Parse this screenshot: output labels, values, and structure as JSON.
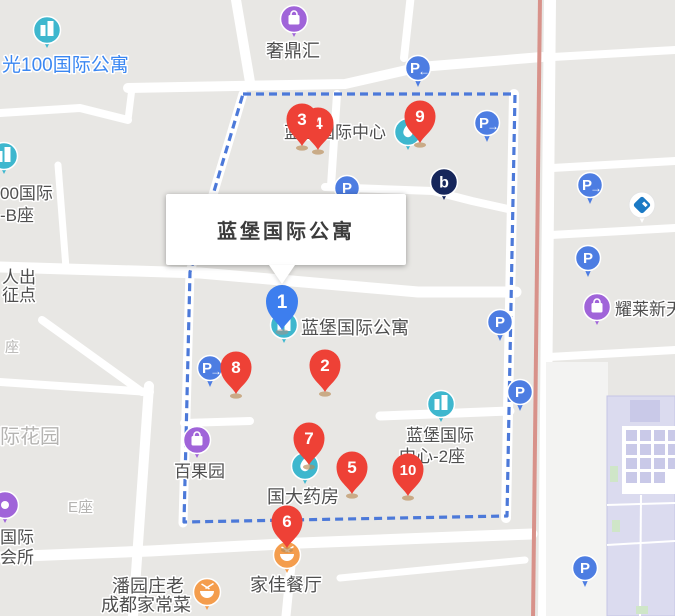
{
  "infobox": {
    "title": "蓝堡国际公寓"
  },
  "markers": {
    "selected": {
      "number": "1"
    },
    "numbered": [
      "2",
      "3",
      "4",
      "5",
      "6",
      "7",
      "8",
      "9",
      "10"
    ]
  },
  "parking": {
    "letter": "P",
    "arrow_left": "←",
    "arrow_right": "→"
  },
  "pois": [
    {
      "id": "guang100",
      "icon": "building",
      "label": "光100国际公寓"
    },
    {
      "id": "bzuo-complex",
      "icon": "building",
      "label_lines": [
        "00国际",
        "-B座"
      ]
    },
    {
      "id": "shedinghui",
      "icon": "shopping-bag",
      "label": "奢鼎汇"
    },
    {
      "id": "lanbao-center",
      "icon": "drop",
      "label": "蓝堡国际中心"
    },
    {
      "id": "brand-b",
      "icon": "letter-b",
      "text": "b"
    },
    {
      "id": "ccb-bank",
      "icon": "bank"
    },
    {
      "id": "lanbao-apartment",
      "icon": "building",
      "label": "蓝堡国际公寓"
    },
    {
      "id": "baiguoyuan",
      "icon": "shopping-bag",
      "label": "百果园"
    },
    {
      "id": "guoda-pharmacy",
      "icon": "drop",
      "label": "国大药房"
    },
    {
      "id": "lanbao-center-2",
      "icon": "building",
      "label_lines": [
        "蓝堡国际",
        "中心-2座"
      ]
    },
    {
      "id": "yaolai",
      "icon": "shopping-bag",
      "label": "耀莱新天"
    },
    {
      "id": "club",
      "icon": "dot",
      "label_lines": [
        "国际",
        "会所"
      ]
    },
    {
      "id": "jiajia-restaurant",
      "icon": "food-bowl",
      "label": "家佳餐厅"
    },
    {
      "id": "panyuanzhuang",
      "icon": "food-bowl",
      "label_lines": [
        "潘园庄老",
        "成都家常菜"
      ]
    }
  ],
  "area_labels": [
    {
      "id": "renchu",
      "lines": [
        "人出",
        "征点"
      ]
    },
    {
      "id": "zuo",
      "text": "座"
    },
    {
      "id": "jihuayuan",
      "text": "际花园"
    },
    {
      "id": "ezuo",
      "text": "E座"
    }
  ],
  "colors": {
    "red_marker": "#ee4136",
    "blue_marker": "#3d7eee",
    "parking_blue": "#4d7de2",
    "teal_poi": "#3eb7ce",
    "purple_poi": "#a064d9",
    "orange_poi": "#f49d4d",
    "navy_brand": "#16265b",
    "bank_blue": "#1b79c4",
    "dashed_border": "#4c79d9",
    "highlight_road": "#d8928a",
    "label_dark": "#4f4f4f",
    "label_light": "#b5b4b2",
    "label_blue": "#3b87f2"
  }
}
